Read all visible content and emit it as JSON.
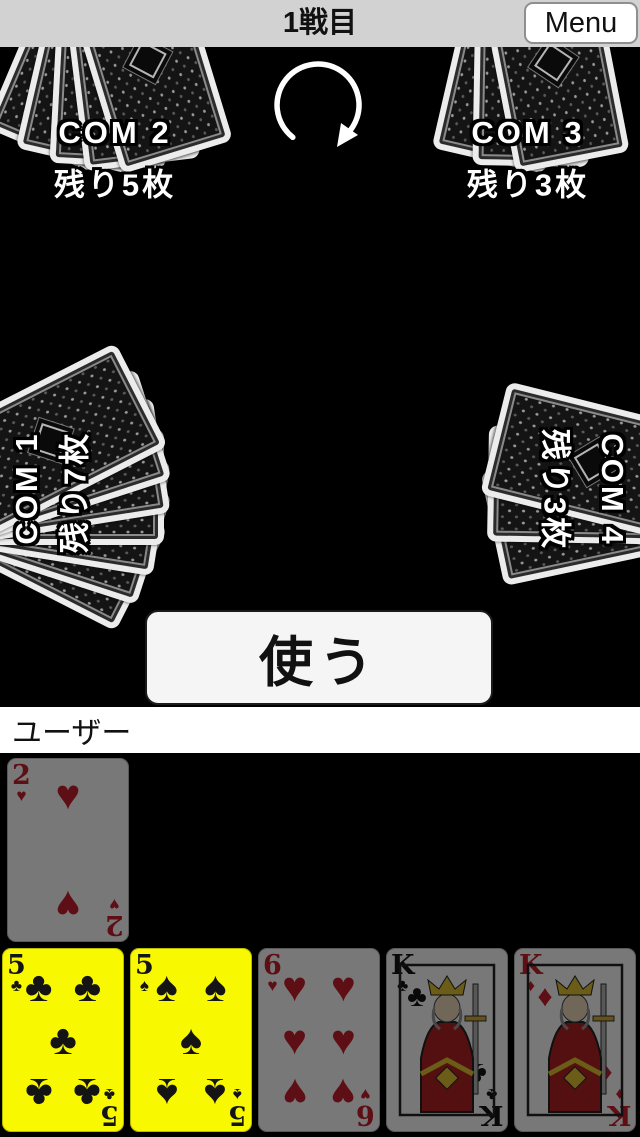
{
  "header": {
    "title": "1戦目",
    "menu_label": "Menu"
  },
  "icons": {
    "turn_direction": "clockwise-rotation-arrow"
  },
  "opponents": [
    {
      "id": "com1",
      "name": "COM 1",
      "remaining": "残り7枚",
      "cards": 7,
      "position": "left"
    },
    {
      "id": "com2",
      "name": "COM 2",
      "remaining": "残り5枚",
      "cards": 5,
      "position": "top-left"
    },
    {
      "id": "com3",
      "name": "COM 3",
      "remaining": "残り3枚",
      "cards": 3,
      "position": "top-right"
    },
    {
      "id": "com4",
      "name": "COM 4",
      "remaining": "残り3枚",
      "cards": 3,
      "position": "right"
    }
  ],
  "action_button": {
    "label": "使う"
  },
  "player": {
    "label": "ユーザー",
    "hand": [
      {
        "rank": "2",
        "suit": "heart",
        "selected": false,
        "raised": true
      },
      {
        "rank": "5",
        "suit": "club",
        "selected": true,
        "raised": false
      },
      {
        "rank": "5",
        "suit": "spade",
        "selected": true,
        "raised": false
      },
      {
        "rank": "6",
        "suit": "heart",
        "selected": false,
        "raised": false
      },
      {
        "rank": "K",
        "suit": "club",
        "selected": false,
        "raised": false
      },
      {
        "rank": "K",
        "suit": "diamond",
        "selected": false,
        "raised": false
      }
    ]
  },
  "colors": {
    "selected_card": "#f8f800",
    "red_suit": "#c81e2d",
    "black_suit": "#141414"
  }
}
